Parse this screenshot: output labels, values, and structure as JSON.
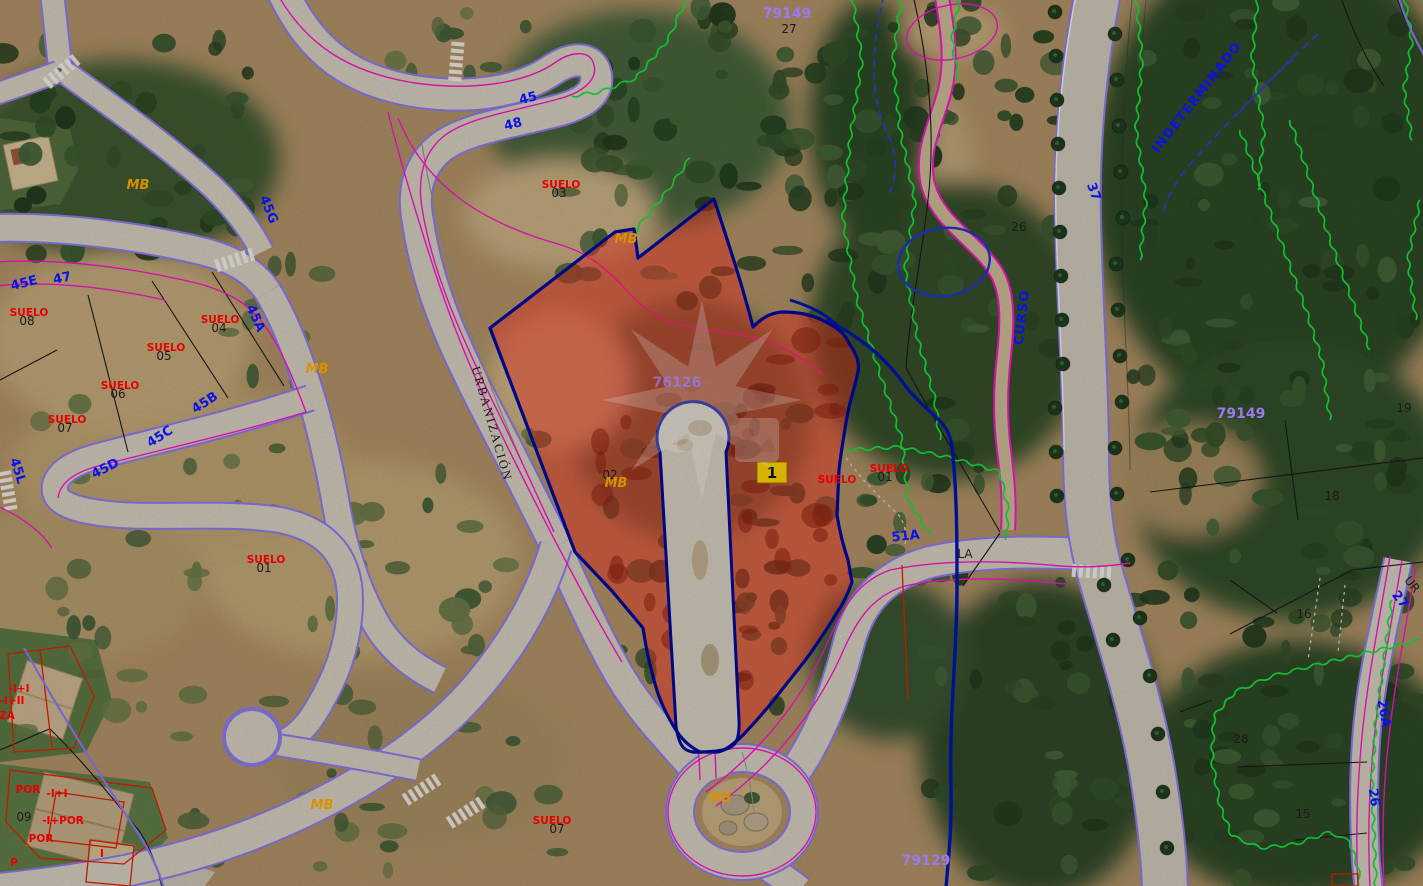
{
  "badge": {
    "label": "1"
  },
  "labels": [
    {
      "t": "47",
      "x": 63,
      "y": 282,
      "r": -12,
      "k": "b"
    },
    {
      "t": "45E",
      "x": 25,
      "y": 287,
      "r": -14,
      "k": "b"
    },
    {
      "t": "45A",
      "x": 252,
      "y": 320,
      "r": 66,
      "k": "b"
    },
    {
      "t": "45B",
      "x": 207,
      "y": 406,
      "r": -33,
      "k": "b"
    },
    {
      "t": "45C",
      "x": 162,
      "y": 440,
      "r": -33,
      "k": "b"
    },
    {
      "t": "45D",
      "x": 107,
      "y": 472,
      "r": -27,
      "k": "b"
    },
    {
      "t": "45L",
      "x": 14,
      "y": 472,
      "r": 72,
      "k": "b"
    },
    {
      "t": "45G",
      "x": 265,
      "y": 211,
      "r": 68,
      "k": "b"
    },
    {
      "t": "45",
      "x": 529,
      "y": 102,
      "r": -14,
      "k": "b"
    },
    {
      "t": "48",
      "x": 514,
      "y": 128,
      "r": -14,
      "k": "b"
    },
    {
      "t": "51A",
      "x": 906,
      "y": 540,
      "r": -6,
      "k": "b",
      "s": 16
    },
    {
      "t": "37",
      "x": 1090,
      "y": 193,
      "r": 70,
      "k": "b"
    },
    {
      "t": "27",
      "x": 1397,
      "y": 602,
      "r": 52,
      "k": "b"
    },
    {
      "t": "26A",
      "x": 1380,
      "y": 714,
      "r": 80,
      "k": "b"
    },
    {
      "t": "26",
      "x": 1370,
      "y": 798,
      "r": 82,
      "k": "b"
    },
    {
      "t": "CURSO",
      "x": 1026,
      "y": 318,
      "r": -83,
      "k": "b",
      "s": 14,
      "ls": 1
    },
    {
      "t": "INDETERMINADO",
      "x": 1200,
      "y": 100,
      "r": -52,
      "k": "b",
      "s": 13,
      "ls": 1
    },
    {
      "t": "79149",
      "x": 787,
      "y": 18,
      "k": "p",
      "s": 12
    },
    {
      "t": "79149",
      "x": 1241,
      "y": 418,
      "k": "p",
      "s": 16
    },
    {
      "t": "79129",
      "x": 926,
      "y": 865,
      "k": "p",
      "s": 15
    },
    {
      "t": "76126",
      "x": 677,
      "y": 387,
      "k": "p",
      "s": 15,
      "o": 0.75
    },
    {
      "t": "27",
      "x": 789,
      "y": 33,
      "k": "k"
    },
    {
      "t": "26",
      "x": 1019,
      "y": 231,
      "k": "k"
    },
    {
      "t": "19",
      "x": 1404,
      "y": 412,
      "k": "k"
    },
    {
      "t": "18",
      "x": 1332,
      "y": 500,
      "k": "k"
    },
    {
      "t": "16",
      "x": 1304,
      "y": 618,
      "k": "k"
    },
    {
      "t": "15",
      "x": 1303,
      "y": 818,
      "k": "k"
    },
    {
      "t": "28",
      "x": 1241,
      "y": 743,
      "k": "k"
    },
    {
      "t": "09",
      "x": 24,
      "y": 821,
      "k": "k",
      "s": 13
    },
    {
      "t": "02",
      "x": 610,
      "y": 479,
      "k": "k"
    },
    {
      "t": "LA",
      "x": 965,
      "y": 558,
      "k": "k",
      "s": 13
    },
    {
      "t": "UR",
      "x": 1409,
      "y": 587,
      "r": 52,
      "k": "k",
      "s": 11
    },
    {
      "t": "01",
      "x": 885,
      "y": 481,
      "k": "k"
    },
    {
      "t": "01",
      "x": 264,
      "y": 572,
      "k": "k"
    },
    {
      "t": "03",
      "x": 559,
      "y": 197,
      "k": "k"
    },
    {
      "t": "04",
      "x": 219,
      "y": 332,
      "k": "k"
    },
    {
      "t": "05",
      "x": 164,
      "y": 360,
      "k": "k"
    },
    {
      "t": "06",
      "x": 118,
      "y": 398,
      "k": "k"
    },
    {
      "t": "07",
      "x": 65,
      "y": 432,
      "k": "k"
    },
    {
      "t": "08",
      "x": 27,
      "y": 325,
      "k": "k"
    },
    {
      "t": "07",
      "x": 557,
      "y": 833,
      "k": "k"
    },
    {
      "t": "SUELO",
      "x": 561,
      "y": 188,
      "k": "r"
    },
    {
      "t": "SUELO",
      "x": 220,
      "y": 323,
      "k": "r"
    },
    {
      "t": "SUELO",
      "x": 166,
      "y": 351,
      "k": "r"
    },
    {
      "t": "SUELO",
      "x": 120,
      "y": 389,
      "k": "r"
    },
    {
      "t": "SUELO",
      "x": 67,
      "y": 423,
      "k": "r"
    },
    {
      "t": "SUELO",
      "x": 29,
      "y": 316,
      "k": "r"
    },
    {
      "t": "SUELO",
      "x": 889,
      "y": 472,
      "k": "r"
    },
    {
      "t": "SUELO",
      "x": 266,
      "y": 563,
      "k": "r"
    },
    {
      "t": "SUELO",
      "x": 552,
      "y": 824,
      "k": "r"
    },
    {
      "t": "SUELO",
      "x": 837,
      "y": 483,
      "k": "r"
    },
    {
      "t": "-I+I",
      "x": 19,
      "y": 692,
      "k": "r"
    },
    {
      "t": "-I+II",
      "x": 12,
      "y": 704,
      "k": "r"
    },
    {
      "t": "ZA",
      "x": 7,
      "y": 719,
      "k": "r"
    },
    {
      "t": "POR",
      "x": 28,
      "y": 793,
      "k": "r"
    },
    {
      "t": "-I+I",
      "x": 57,
      "y": 797,
      "k": "r"
    },
    {
      "t": "-I+POR",
      "x": 63,
      "y": 824,
      "k": "r"
    },
    {
      "t": "POR",
      "x": 41,
      "y": 842,
      "k": "r"
    },
    {
      "t": "P",
      "x": 14,
      "y": 866,
      "k": "r"
    },
    {
      "t": "I",
      "x": 102,
      "y": 857,
      "k": "r"
    },
    {
      "t": "MB",
      "x": 138,
      "y": 189,
      "k": "o"
    },
    {
      "t": "MB",
      "x": 322,
      "y": 809,
      "k": "o"
    },
    {
      "t": "MB",
      "x": 720,
      "y": 802,
      "k": "o"
    },
    {
      "t": "MB",
      "x": 616,
      "y": 487,
      "k": "o"
    },
    {
      "t": "MB",
      "x": 626,
      "y": 243,
      "k": "o"
    },
    {
      "t": "MB",
      "x": 317,
      "y": 373,
      "k": "o"
    },
    {
      "t": "URBANIZACIÓN",
      "x": 488,
      "y": 425,
      "r": 74,
      "k": "rd"
    }
  ]
}
